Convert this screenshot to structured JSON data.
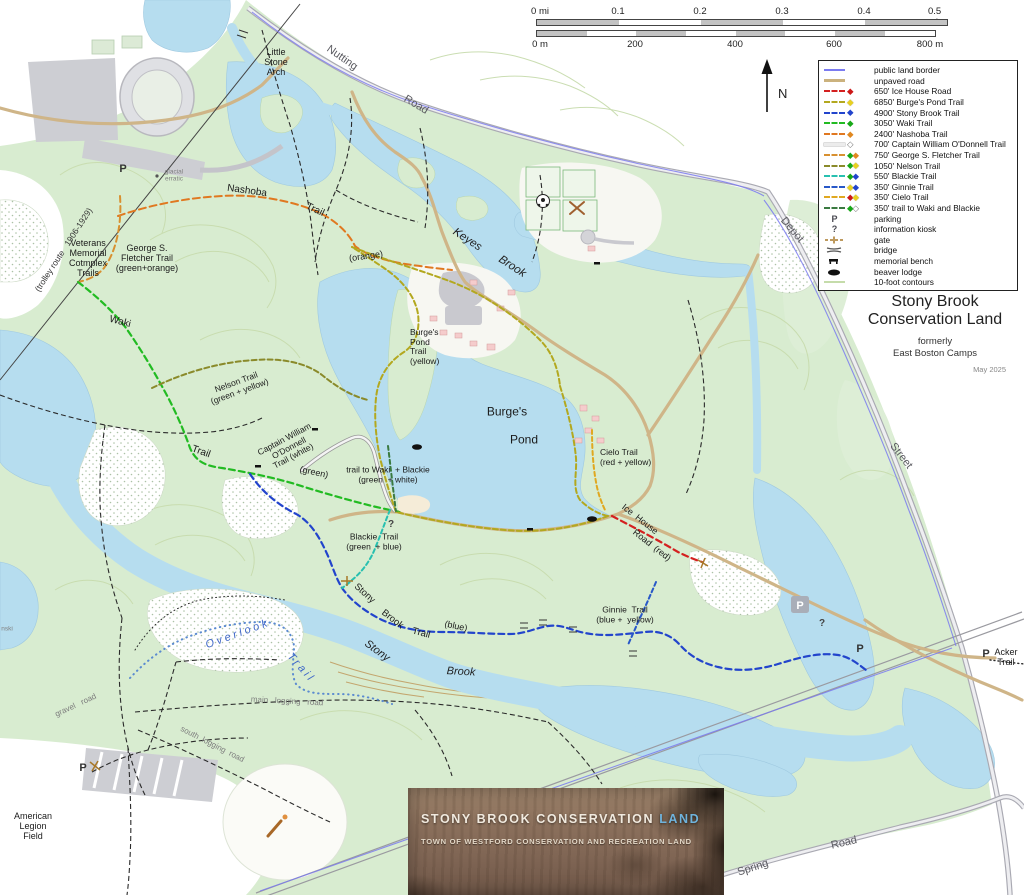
{
  "icons": {
    "parking": "P",
    "kiosk": "?",
    "north": "N"
  },
  "scale_bar": {
    "miles": [
      "0 mi",
      "0.1",
      "0.2",
      "0.3",
      "0.4",
      "0.5 mi"
    ],
    "meters": [
      "0 m",
      "200",
      "400",
      "600",
      "800 m"
    ]
  },
  "legend": {
    "items": [
      {
        "label": "public land border",
        "line": "#7b7bf0",
        "blazes": []
      },
      {
        "label": "unpaved road",
        "line": "#cbb27e",
        "blazes": []
      },
      {
        "label": "650' Ice House Road",
        "line": "#d42020",
        "blazes": [
          "red"
        ]
      },
      {
        "label": "6850' Burge's Pond Trail",
        "line": "#b3a81f",
        "blazes": [
          "yellow"
        ]
      },
      {
        "label": "4900' Stony Brook Trail",
        "line": "#2244cc",
        "blazes": [
          "blue"
        ]
      },
      {
        "label": "3050' Waki Trail",
        "line": "#22bb22",
        "blazes": [
          "green"
        ]
      },
      {
        "label": "2400' Nashoba Trail",
        "line": "#e07820",
        "blazes": [
          "orange"
        ]
      },
      {
        "label": "700' Captain William O'Donnell Trail",
        "line": "#ececec",
        "blazes": [
          "white"
        ]
      },
      {
        "label": "750' George S. Fletcher Trail",
        "line": "#d89030",
        "blazes": [
          "green",
          "orange"
        ]
      },
      {
        "label": "1050' Nelson Trail",
        "line": "#8a8a2a",
        "blazes": [
          "green",
          "yellow"
        ]
      },
      {
        "label": "550' Blackie Trail",
        "line": "#28c0b0",
        "blazes": [
          "green",
          "blue"
        ]
      },
      {
        "label": "350' Ginnie Trail",
        "line": "#2858c8",
        "blazes": [
          "yellow",
          "blue"
        ]
      },
      {
        "label": "350' Cielo Trail",
        "line": "#e0a820",
        "blazes": [
          "red",
          "yellow"
        ]
      },
      {
        "label": "350' trail to Waki and Blackie",
        "line": "#3a7a40",
        "blazes": [
          "green",
          "white"
        ]
      },
      {
        "label": "parking",
        "icon": "parking"
      },
      {
        "label": "information kiosk",
        "icon": "kiosk"
      },
      {
        "label": "gate",
        "icon": "gate"
      },
      {
        "label": "bridge",
        "icon": "bridge"
      },
      {
        "label": "memorial bench",
        "icon": "bench"
      },
      {
        "label": "beaver lodge",
        "icon": "beaver"
      },
      {
        "label": "10-foot contours",
        "line": "#c5dcaa",
        "blazes": []
      }
    ]
  },
  "title_block": {
    "line1": "Stony Brook",
    "line2": "Conservation Land",
    "sub1": "formerly",
    "sub2": "East Boston Camps",
    "date": "May 2025"
  },
  "banner": {
    "title_white": "STONY BROOK CONSERVATION ",
    "title_blue": "LAND",
    "subtitle": "TOWN OF WESTFORD CONSERVATION AND RECREATION LAND"
  },
  "map_labels": {
    "little_stone_arch": "Little\nStone\nArch",
    "nutting": "Nutting",
    "nutting_road": "Road",
    "veterans": "Veterans\nMemorial\nCotmplex\nTrails",
    "trolley": "(trolley route   1906-1929)",
    "nashoba": "Nashoba",
    "nashoba_trail": "Trail",
    "glacial": "glacial\nerratic",
    "fletcher": "George S.\nFletcher Trail\n(green+orange)",
    "waki": "Waki",
    "waki_trail": "Trail",
    "waki_green": "(green)",
    "keyes": "Keyes",
    "keyes_brook": "Brook",
    "orange": "(orange)",
    "burges_pond_trail": "Burge's\nPond\nTrail\n(yellow)",
    "nelson": "Nelson Trail\n(green + yellow)",
    "odonnell": "Captain William\nO'Donnell\nTrail (white)",
    "conn_waki_blackie": "trail to Waki  + Blackie\n(green  + white)",
    "burges": "Burge's",
    "pond": "Pond",
    "cielo": "Cielo Trail\n(red + yellow)",
    "ice_house": "Ice  House",
    "ice_road": "Road  (red)",
    "blackie": "Blackie  Trail\n(green  + blue)",
    "stony1": "Stony",
    "brook1": "Brook",
    "trail1": "Trail",
    "blue1": "(blue)",
    "ginnie": "Ginnie  Trail\n(blue +  yellow)",
    "stony_w": "Stony",
    "brook_w": "Brook",
    "overlook": "Overlook",
    "overlook_trail": "Trail",
    "main_logging": "main   logging   road",
    "south_logging": "south  logging  road",
    "gravel_road": "gravel   road",
    "american": "American\nLegion\nField",
    "acker": "Acker\nTrail",
    "spring": "Spring",
    "spring_road": "Road",
    "depot": "Depot",
    "street": "Street",
    "nski": "nski"
  },
  "colors": {
    "land_green": "#d8ecd0",
    "water": "#b6ddef",
    "unpaved_road": "#cbb27e",
    "public_border": "#7b7bf0",
    "contour": "#c8dcae"
  }
}
